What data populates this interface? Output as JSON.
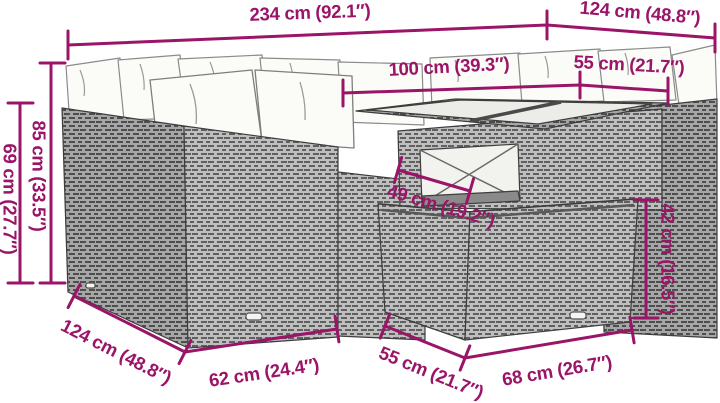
{
  "diagram": {
    "type": "product-dimension-diagram",
    "subject": "rattan-corner-sofa-set-with-table-and-ottoman",
    "colors": {
      "dimension_accent": "#9A1468",
      "background": "#FFFFFF",
      "wicker_light": "#BFBFBF",
      "wicker_dark": "#A6A6A6",
      "wicker_weave": "#606060",
      "cushion": "#FBFBF8",
      "outline": "#3D3D3D",
      "glass_top": "#ECECE8"
    },
    "dims": {
      "total_width": "234 cm (92.1″)",
      "total_depth": "124 cm (48.8″)",
      "table_length": "100 cm (39.3″)",
      "right_seat_width": "55 cm (21.7″)",
      "back_height": "85 cm (33.5″)",
      "arm_height": "69 cm (27.7″)",
      "seat_depth": "49 cm (19.2″)",
      "ottoman_height": "42 cm (16.5″)",
      "left_depth": "124 cm (48.8″)",
      "left_seat_width": "62 cm (24.4″)",
      "ottoman_depth": "55 cm (21.7″)",
      "ottoman_width": "68 cm (26.7″)"
    }
  }
}
